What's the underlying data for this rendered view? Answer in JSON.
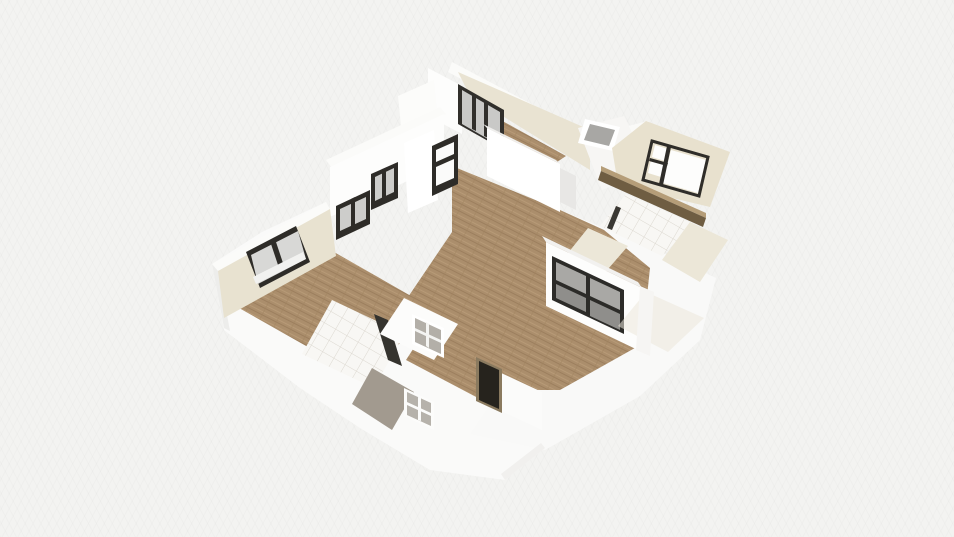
{
  "meta": {
    "view": "3d-floorplan-birdseye",
    "visible_text": []
  },
  "canvas": {
    "width": 954,
    "height": 537,
    "background": "#f3f3f1"
  },
  "palette": {
    "background": "#f3f3f1",
    "wall_white": "#fdfdfc",
    "wall_top_white": "#fbfbf9",
    "wall_cream": "#e8e2d0",
    "floor_wood": "#ab8e6c",
    "window_frame_dark": "#2e2c28",
    "window_glass_gray": "#a9a8a5",
    "window_glass_light": "#d8d8d6",
    "tile_white": "#f8f7f4",
    "tile_joint": "#dcd8d0",
    "entry_door_dark": "#26231d",
    "shower_pad_gray": "#a29a8f",
    "ledge_brown_dark": "#6f5d42",
    "ledge_brown_light": "#b59d78"
  },
  "scene": {
    "polygons": [
      {
        "name": "exterior-wall-mass-left",
        "fill": "#fafaf9",
        "points": "212,264 224,330 300,388 360,428 430,470 505,480 545,448 480,392 446,316 334,252 326,202 262,232"
      },
      {
        "name": "exterior-wall-mass-right",
        "fill": "#f9f9f8",
        "points": "560,210 648,246 716,278 700,340 640,396 545,450 470,434 520,360 545,306 552,258"
      },
      {
        "name": "exterior-corner-edge-left",
        "fill": "#ededeb",
        "points": "212,264 218,267 230,331 224,328"
      },
      {
        "name": "exterior-edge-bottom",
        "fill": "#f1f0ee",
        "points": "505,480 545,448 541,443 501,474"
      },
      {
        "name": "living-room-floor",
        "fill": "wood",
        "points": "452,166 560,210 604,230 650,268 642,344 560,390 468,390 404,340 406,300 452,232"
      },
      {
        "name": "hallway-floor",
        "fill": "wood",
        "points": "428,326 502,362 478,398 406,360"
      },
      {
        "name": "bedroom-left-floor",
        "fill": "wood",
        "points": "334,252 446,316 352,372 232,304"
      },
      {
        "name": "top-room-walltop-ne",
        "fill": "#fbfbf9",
        "points": "452,62 592,136 588,146 448,72"
      },
      {
        "name": "top-room-wall-ne-cream",
        "fill": "#e9e3d2",
        "points": "458,72 590,130 590,170 470,96"
      },
      {
        "name": "top-room-floor-strip",
        "fill": "wood",
        "points": "497,118 566,156 548,168 487,132"
      },
      {
        "name": "top-room-wall-nw-white",
        "fill": "#fdfdfc",
        "points": "428,68 462,86 462,134 428,116"
      },
      {
        "name": "top-room-window-frame",
        "fill": "#312f2b",
        "points": "458,84 504,110 504,150 458,124"
      },
      {
        "name": "top-room-window-glass",
        "fill": "#c9c9c7",
        "points": "462,90 500,112 500,146 462,124"
      },
      {
        "name": "top-room-window-mullion-a",
        "fill": "#312f2b",
        "points": "472,95 476,97 476,131 472,129"
      },
      {
        "name": "top-room-window-mullion-b",
        "fill": "#312f2b",
        "points": "484,102 488,104 488,138 484,136"
      },
      {
        "name": "nw-junction-wall",
        "fill": "#fcfcfa",
        "points": "398,96 434,80 440,140 404,156"
      },
      {
        "name": "topright-walltop-band",
        "fill": "#fafaf8",
        "points": "588,136 648,121 654,128 594,144"
      },
      {
        "name": "topright-wall-white",
        "fill": "#f7f6f4",
        "points": "578,128 624,116 650,170 602,190"
      },
      {
        "name": "skylight-frame",
        "fill": "#ffffff",
        "points": "585,119 620,127 613,151 578,143"
      },
      {
        "name": "skylight-glass",
        "fill": "#a8a7a4",
        "points": "590,124 615,130 609,146 584,140"
      },
      {
        "name": "right-room-wall-cream-panel",
        "fill": "#e8e1ce",
        "points": "612,148 646,121 730,152 710,207 618,185"
      },
      {
        "name": "right-room-window-pane-top",
        "fill": "#fdfdfc",
        "points": "655,145 668,149 665,161 652,157"
      },
      {
        "name": "right-room-window-pane-bottom",
        "fill": "#fdfdfc",
        "points": "651,160 664,164 661,177 648,173"
      },
      {
        "name": "right-room-window-pane-large",
        "fill": "#fdfdfc",
        "points": "671,150 706,160 698,193 663,183"
      },
      {
        "name": "right-room-window-frame",
        "fill": "none",
        "stroke": "#2f2d29",
        "strokeWidth": 3,
        "points": "652,141 708,157 699,196 643,180"
      },
      {
        "name": "right-room-window-frame-vert",
        "fill": "#2f2d29",
        "points": "667,146 671,147 663,185 659,184"
      },
      {
        "name": "right-room-window-frame-horiz",
        "fill": "#2f2d29",
        "points": "650,158 668,163 667,166 649,161"
      },
      {
        "name": "right-room-ledge-top",
        "fill": "#b59d78",
        "points": "601,166 706,213 706,218 601,171"
      },
      {
        "name": "right-room-ledge-face",
        "fill": "#6f5d42",
        "points": "601,171 706,218 703,227 598,180"
      },
      {
        "name": "bathroom-right-tiles",
        "fill": "tile",
        "points": "626,194 694,224 662,256 600,226"
      },
      {
        "name": "bathroom-right-door-edge",
        "fill": "#3a3833",
        "points": "616,206 621,208 612,230 607,228"
      },
      {
        "name": "bathroom-right-cream-left",
        "fill": "#ece7d8",
        "points": "588,228 628,246 602,276 564,258"
      },
      {
        "name": "bathroom-right-cream-right",
        "fill": "#ece7d8",
        "points": "690,222 728,240 700,282 662,260"
      },
      {
        "name": "kitchen-halfwall-top",
        "fill": "#fbfbf9",
        "points": "326,160 440,107 446,114 332,168"
      },
      {
        "name": "kitchen-halfwall-face",
        "fill": "#fdfdfc",
        "points": "330,167 444,114 444,164 330,217"
      },
      {
        "name": "kitchen-window-a-frame",
        "fill": "#2e2c28",
        "points": "336,206 370,190 370,224 336,240"
      },
      {
        "name": "kitchen-window-a-glass",
        "fill": "#cdcdcb",
        "points": "340,209 366,197 366,219 340,231"
      },
      {
        "name": "kitchen-window-a-mullion",
        "fill": "#2e2c28",
        "points": "351,199 355,197 355,225 351,227"
      },
      {
        "name": "kitchen-window-b-frame",
        "fill": "#2e2c28",
        "points": "371,174 398,162 398,198 371,210"
      },
      {
        "name": "kitchen-window-b-glass",
        "fill": "#cdcdcb",
        "points": "375,177 394,168 394,192 375,201"
      },
      {
        "name": "kitchen-window-b-mullion",
        "fill": "#2e2c28",
        "points": "382,171 386,169 386,197 382,199"
      },
      {
        "name": "kitchen-pillar",
        "fill": "#ffffff",
        "points": "404,143 434,130 438,200 408,213"
      },
      {
        "name": "kitchen-tall-window-frame",
        "fill": "#2e2c28",
        "points": "432,146 458,134 458,184 432,196"
      },
      {
        "name": "kitchen-tall-window-glass",
        "fill": "#fbfbfa",
        "points": "436,150 454,142 454,178 436,186"
      },
      {
        "name": "kitchen-tall-window-bar",
        "fill": "#2e2c28",
        "points": "436,162 454,154 454,159 436,167"
      },
      {
        "name": "bedroom-walltop-nw",
        "fill": "#fbfbf9",
        "points": "326,202 212,264 218,271 330,209"
      },
      {
        "name": "bedroom-wall-nw-cream",
        "fill": "#e8e2d0",
        "points": "330,209 218,271 224,318 336,256"
      },
      {
        "name": "bedroom-window-frame",
        "fill": "#2e2c28",
        "points": "246,252 296,226 310,262 260,288"
      },
      {
        "name": "bedroom-window-glass",
        "fill": "#d8d8d6",
        "points": "251,255 298,231 306,259 258,284"
      },
      {
        "name": "bedroom-window-mullion",
        "fill": "#2e2c28",
        "points": "271,244 276,242 285,269 280,271"
      },
      {
        "name": "bedroom-window-sill",
        "fill": "#f2f2f0",
        "points": "253,277 303,252 306,259 256,284"
      },
      {
        "name": "bathroom-left-tiles",
        "fill": "tile",
        "points": "332,300 404,334 374,388 302,354"
      },
      {
        "name": "bathroom-left-door-edge",
        "fill": "#35332e",
        "points": "374,314 388,320 402,366 388,360"
      },
      {
        "name": "shower-pad",
        "fill": "#a29a8f",
        "points": "372,368 414,392 392,430 352,404"
      },
      {
        "name": "hallway-wall-white",
        "fill": "#fcfcfb",
        "points": "404,298 458,324 434,360 380,334"
      },
      {
        "name": "glass-panel-frame",
        "fill": "#ffffff",
        "points": "412,314 444,328 444,358 412,344"
      },
      {
        "name": "glass-panel-glass",
        "fill": "#b3afa8",
        "points": "415,318 441,330 441,354 415,342"
      },
      {
        "name": "glass-panel-bar-h",
        "fill": "#f4f4f2",
        "points": "415,328 441,340 441,343 415,331"
      },
      {
        "name": "glass-panel-bar-v",
        "fill": "#f4f4f2",
        "points": "426,322 429,324 429,348 426,346"
      },
      {
        "name": "partition-wall-top",
        "fill": "#f0efed",
        "points": "483,124 556,160 560,164 487,128"
      },
      {
        "name": "partition-wall-front",
        "fill": "#ffffff",
        "points": "487,128 560,164 560,212 487,176"
      },
      {
        "name": "partition-doorway-gap",
        "fill": "#e8e7e5",
        "points": "560,168 576,176 576,210 560,202"
      },
      {
        "name": "big-window-walltop",
        "fill": "#f2f1ef",
        "points": "542,236 638,282 642,288 546,242"
      },
      {
        "name": "big-window-wall",
        "fill": "#fdfdfc",
        "points": "546,242 642,288 642,352 546,306"
      },
      {
        "name": "big-window-frame",
        "fill": "#2c2b28",
        "points": "552,256 624,290 624,334 552,300"
      },
      {
        "name": "big-window-glass-1",
        "fill": "#a9a8a5",
        "points": "556,262 586,276 586,294 556,280"
      },
      {
        "name": "big-window-glass-2",
        "fill": "#a9a8a5",
        "points": "590,278 620,292 620,310 590,296"
      },
      {
        "name": "big-window-glass-3",
        "fill": "#8f8e8b",
        "points": "556,284 586,298 586,312 556,298"
      },
      {
        "name": "big-window-glass-4",
        "fill": "#8f8e8b",
        "points": "590,300 620,314 620,330 590,316"
      },
      {
        "name": "right-exterior-cream-faint",
        "fill": "#ece7da",
        "opacity": 0.55,
        "points": "646,292 704,318 668,352 618,326"
      },
      {
        "name": "right-exterior-edge-white",
        "fill": "#f6f5f3",
        "points": "640,286 654,292 650,356 636,350"
      },
      {
        "name": "entry-wall-right",
        "fill": "#fbfbfa",
        "points": "499,372 542,392 542,430 499,410"
      },
      {
        "name": "entry-door-frame",
        "fill": "#8a7a5f",
        "points": "476,357 502,369 502,413 476,401"
      },
      {
        "name": "entry-door",
        "fill": "#26231d",
        "points": "479,361 499,370 499,409 479,400"
      },
      {
        "name": "bottom-window-frame",
        "fill": "#fcfcfb",
        "points": "404,388 434,402 434,430 404,416"
      },
      {
        "name": "bottom-window-glass",
        "fill": "#b6b2ab",
        "points": "407,392 431,403 431,426 407,415"
      },
      {
        "name": "bottom-window-bar-h",
        "fill": "#fcfcfb",
        "points": "407,402 431,413 431,416 407,405"
      },
      {
        "name": "bottom-window-bar-v",
        "fill": "#fcfcfb",
        "points": "418,397 421,398 421,421 418,420"
      }
    ]
  }
}
